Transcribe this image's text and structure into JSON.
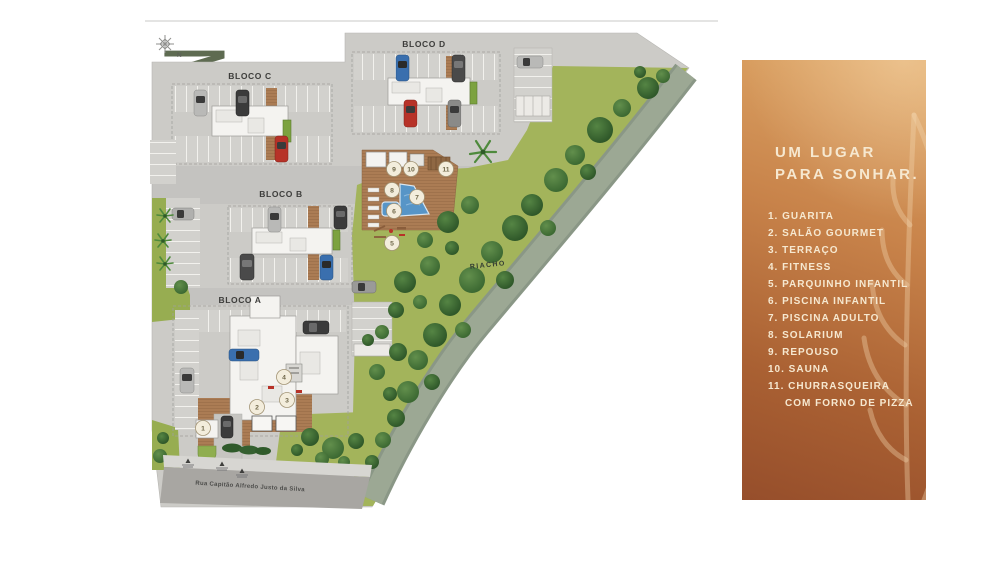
{
  "title": "MASTERPLAN",
  "map": {
    "compass_label": "N",
    "blocks": {
      "a": "BLOCO A",
      "b": "BLOCO B",
      "c": "BLOCO C",
      "d": "BLOCO D"
    },
    "river_label": "RIACHO",
    "street_label": "Rua Capitão Alfredo Justo da Silva",
    "markers": [
      "1",
      "2",
      "3",
      "4",
      "5",
      "6",
      "7",
      "8",
      "9",
      "10",
      "11"
    ]
  },
  "panel": {
    "heading_line1": "UM LUGAR",
    "heading_line2": "PARA SONHAR.",
    "items": [
      "1. GUARITA",
      "2. SALÃO GOURMET",
      "3. TERRAÇO",
      "4. FITNESS",
      "5. PARQUINHO INFANTIL",
      "6. PISCINA INFANTIL",
      "7. PISCINA ADULTO",
      "8. SOLARIUM",
      "9. REPOUSO",
      "10. SAUNA",
      "11. CHURRASQUEIRA"
    ],
    "item11_continuation": "COM FORNO DE PIZZA"
  },
  "colors": {
    "title_green": "#5e6b51",
    "pavement": "#cccbc7",
    "lawn": "#a3b45b",
    "stream": "#99a595",
    "street": "#a8a6a2",
    "deck_wood": "#ab7c54",
    "pool_blue": "#5795c7",
    "panel_gradient_top": "#dfa868",
    "panel_gradient_bottom": "#964e2b",
    "panel_text": "#f6e8d0",
    "marker_fill": "#f3eddc",
    "marker_text": "#6f6749"
  }
}
